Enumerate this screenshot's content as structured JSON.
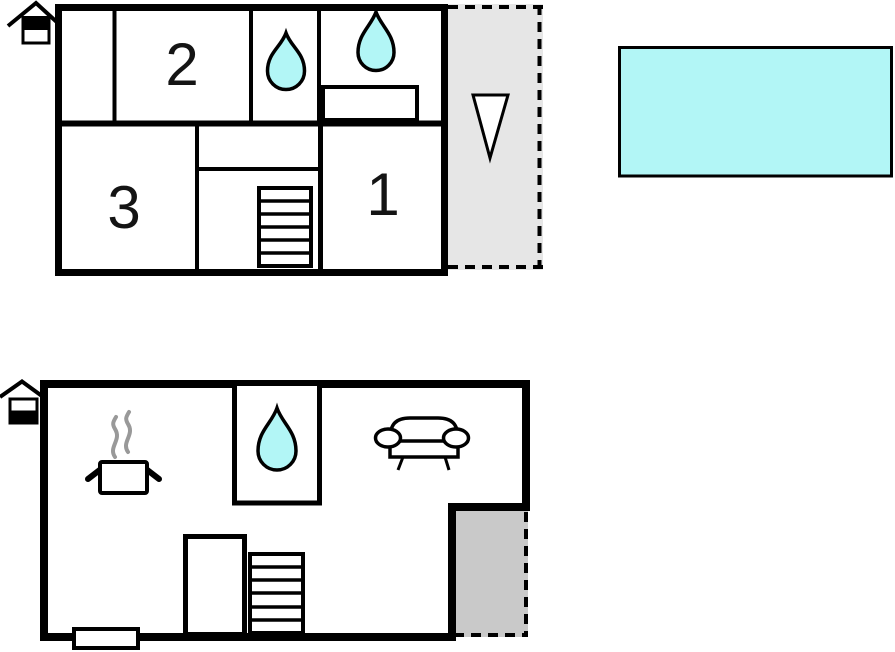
{
  "page": {
    "type": "holiday-home-floor-plan",
    "floors_shown": 2
  },
  "colors": {
    "wall": "#000000",
    "water": "#b2f6f6",
    "pool": "#b2f6f6",
    "balcony_fill": "#e6e6e6",
    "niche_fill": "#c9c9c9",
    "steam": "#999999",
    "arrow_fill": "#ffffff",
    "text": "#141414"
  },
  "upper_floor": {
    "name": "upper-floor-plan",
    "rooms": [
      {
        "id": "bedroom-2",
        "label": "2"
      },
      {
        "id": "bedroom-3",
        "label": "3"
      },
      {
        "id": "bedroom-1",
        "label": "1"
      }
    ],
    "icons": [
      "house-floor-indicator-upper-highlighted",
      "water-drop-bathroom",
      "water-drop-bathroom",
      "sink-counter",
      "staircase-6-steps",
      "balcony-dashed-outline",
      "down-arrow"
    ]
  },
  "ground_floor": {
    "name": "ground-floor-plan",
    "icons": [
      "house-floor-indicator-ground-highlighted",
      "cooking-pot-with-steam",
      "water-drop-bathroom",
      "sofa",
      "wardrobe",
      "staircase-6-steps",
      "entrance-step",
      "covered-niche-dashed-outline"
    ]
  },
  "outside": {
    "icons": [
      "swimming-pool"
    ]
  }
}
